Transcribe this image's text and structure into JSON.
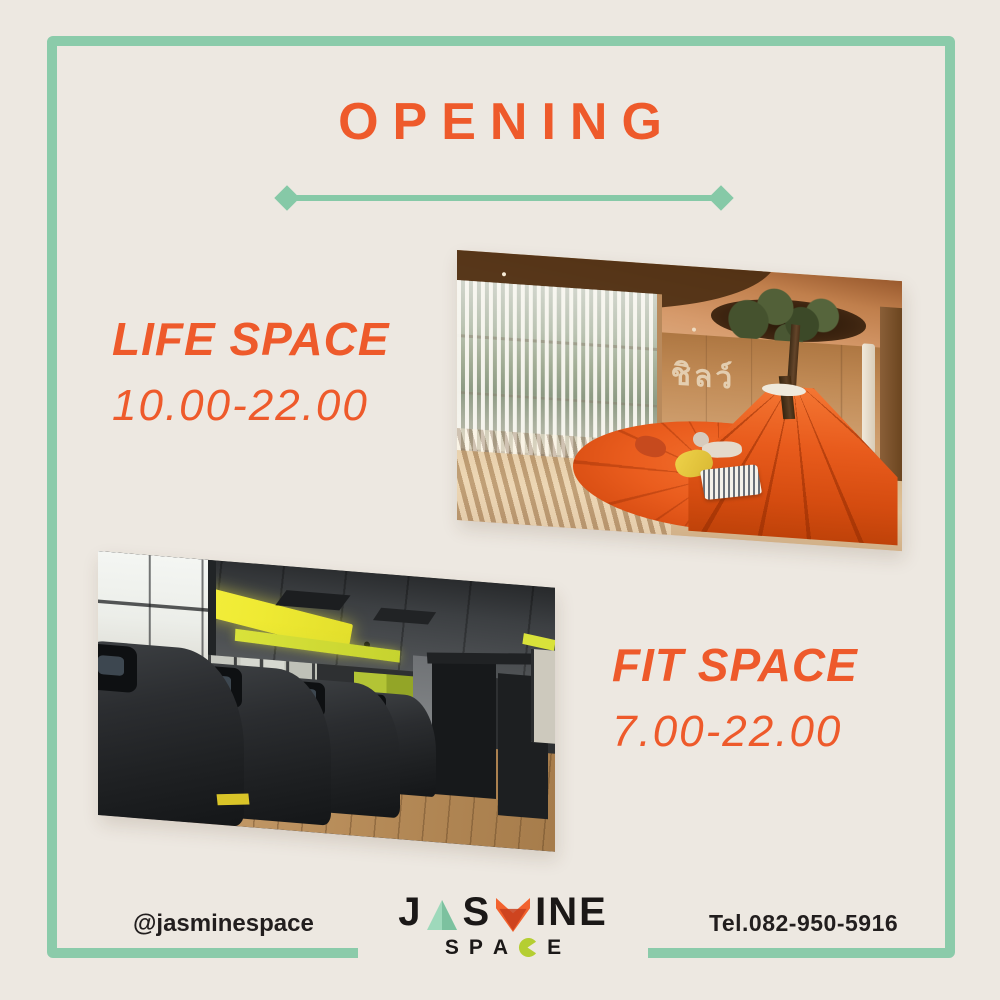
{
  "colors": {
    "background": "#EDE8E1",
    "frame_teal": "#8BCBAA",
    "accent_orange": "#EE5A2B",
    "text_dark": "#221E1E",
    "logo_mint": "#9ED9BB",
    "logo_orange": "#F2622E",
    "logo_red": "#C8401C",
    "logo_lime": "#B5CE32"
  },
  "header": {
    "title": "OPENING"
  },
  "sections": {
    "life_space": {
      "title": "LIFE SPACE",
      "hours": "10.00-22.00",
      "photo_wall_text": "ชิลว์"
    },
    "fit_space": {
      "title": "FIT SPACE",
      "hours": "7.00-22.00"
    }
  },
  "footer": {
    "social_handle": "@jasminespace",
    "phone": "Tel.082-950-5916",
    "logo": {
      "top_j": "J",
      "top_s": "S",
      "top_ine": "INE",
      "bottom_s": "S",
      "bottom_p": "P",
      "bottom_a": "A",
      "bottom_e": "E"
    }
  }
}
